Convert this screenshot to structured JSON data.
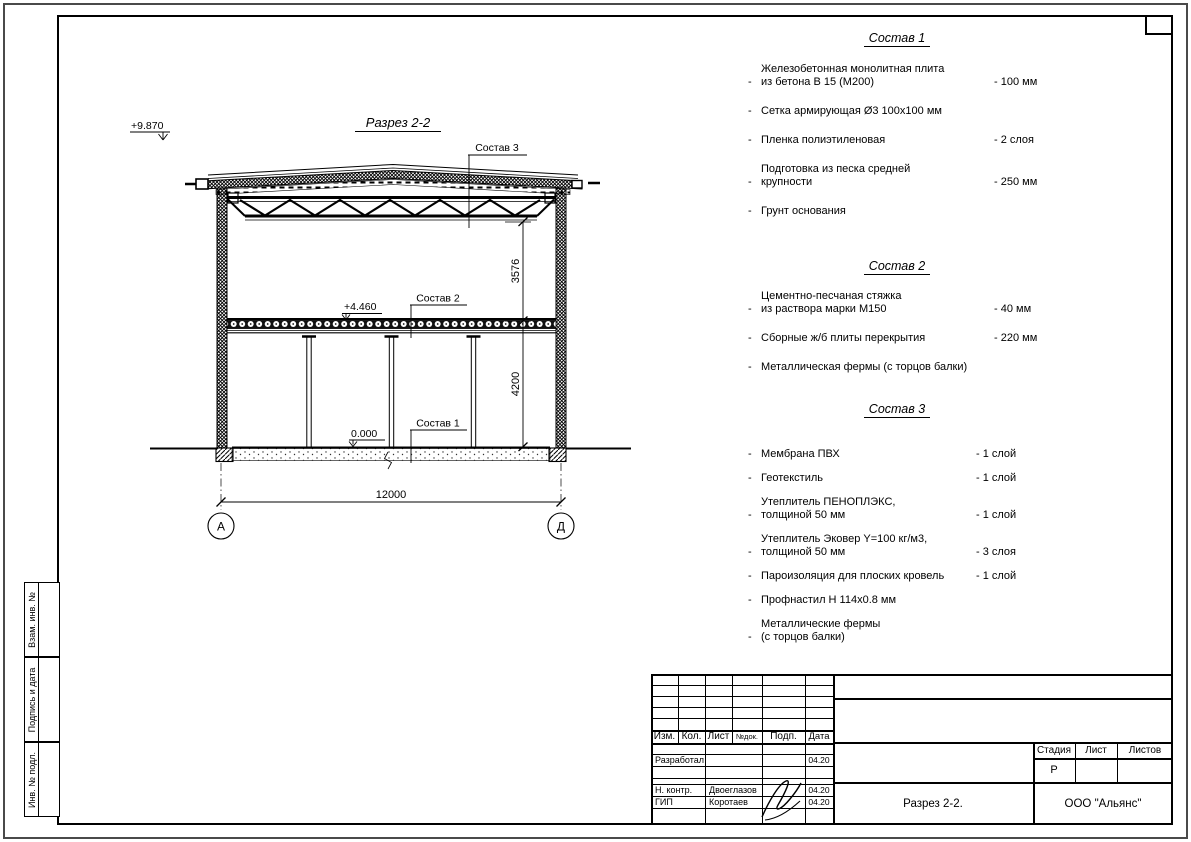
{
  "drawing": {
    "title": "Разрез 2-2",
    "elev_roof": "+9.870",
    "elev_floor": "+4.460",
    "elev_zero": "0.000",
    "dim_upper": "3576",
    "dim_lower": "4200",
    "dim_span": "12000",
    "axis_left": "А",
    "axis_right": "Д",
    "leader_top": "Состав 3",
    "leader_mid": "Состав 2",
    "leader_bottom": "Состав 1"
  },
  "lists": {
    "bullet": "-"
  },
  "compositions": [
    {
      "title": "Состав 1",
      "items": [
        {
          "text": "Железобетонная  монолитная плита\nиз бетона В 15 (М200)",
          "value": "- 100 мм"
        },
        {
          "text": "Сетка армирующая Ø3 100х100 мм",
          "value": ""
        },
        {
          "text": "Пленка полиэтиленовая",
          "value": "- 2 слоя"
        },
        {
          "text": "Подготовка из песка средней\nкрупности",
          "value": "- 250 мм"
        },
        {
          "text": "Грунт основания",
          "value": ""
        }
      ]
    },
    {
      "title": "Состав 2",
      "items": [
        {
          "text": "Цементно-песчаная стяжка\nиз раствора марки М150",
          "value": "- 40 мм"
        },
        {
          "text": "Сборные ж/б плиты перекрытия",
          "value": "- 220 мм"
        },
        {
          "text": "Металлическая фермы (с торцов балки)",
          "value": ""
        }
      ]
    },
    {
      "title": "Состав 3",
      "items": [
        {
          "text": "Мембрана ПВХ",
          "value": "- 1 слой"
        },
        {
          "text": "Геотекстиль",
          "value": "- 1 слой"
        },
        {
          "text": "Утеплитель ПЕНОПЛЭКС,\nтолщиной 50 мм",
          "value": "- 1 слой"
        },
        {
          "text": "Утеплитель Эковер Y=100 кг/м3,\nтолщиной 50 мм",
          "value": "- 3 слоя"
        },
        {
          "text": "Пароизоляция для плоских кровель",
          "value": "- 1 слой"
        },
        {
          "text": "Профнастил Н 114х0.8 мм",
          "value": ""
        },
        {
          "text": "Металлические фермы\n(с торцов балки)",
          "value": ""
        }
      ]
    }
  ],
  "title_block": {
    "header_cols": [
      "Изм.",
      "Кол.",
      "Лист",
      "№док.",
      "Подп.",
      "Дата"
    ],
    "sign_rows": [
      {
        "role": "Разработал",
        "name": "",
        "date": "04.20"
      },
      {
        "role": "Н. контр.",
        "name": "Двоеглазов",
        "date": "04.20"
      },
      {
        "role": "ГИП",
        "name": "Коротаев",
        "date": "04.20"
      }
    ],
    "stage": {
      "label": "Стадия",
      "value": "Р"
    },
    "sheet_col": {
      "label": "Лист"
    },
    "sheets_col": {
      "label": "Листов"
    },
    "doc_title": "Разрез 2-2.",
    "company": "ООО \"Альянс\""
  },
  "side_stamps": {
    "items": [
      "Взам. инв. №",
      "Подпись и дата",
      "Инв. № подл."
    ]
  }
}
